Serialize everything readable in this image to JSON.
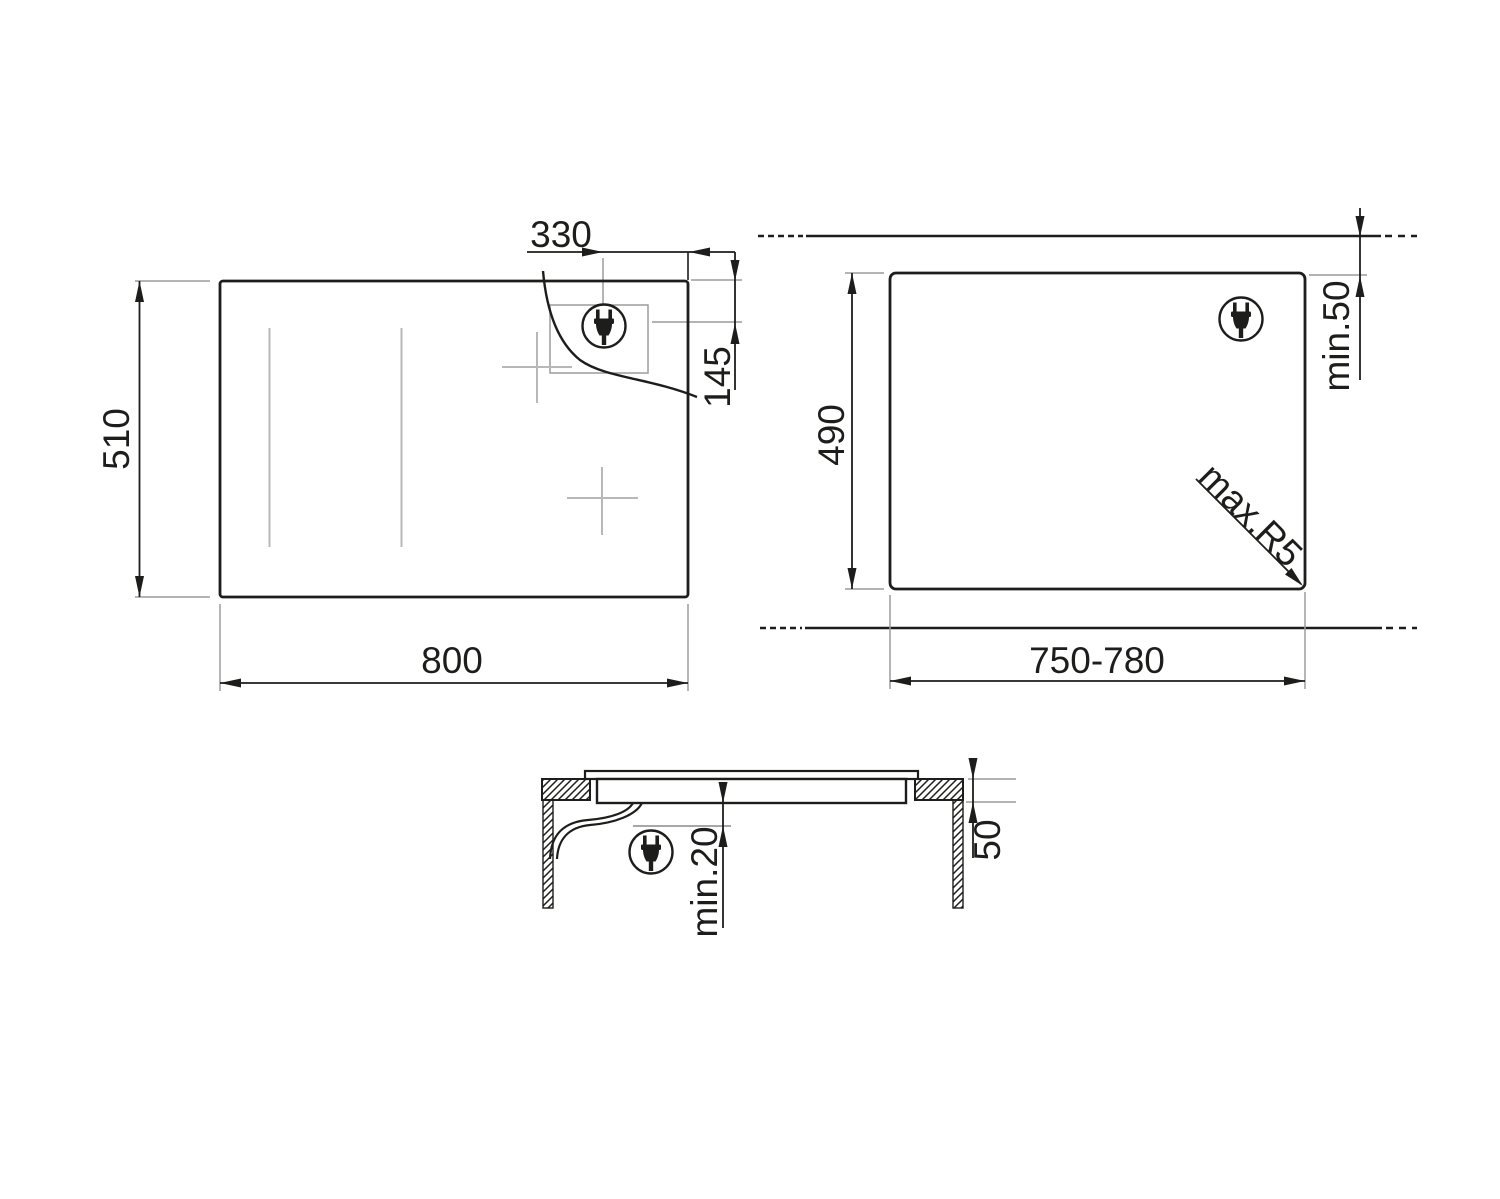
{
  "drawing": {
    "background": "#ffffff",
    "colors": {
      "line": "#1d1d1b",
      "extension": "#9c9c9c",
      "zone": "#b8b8b8"
    },
    "icons": {
      "plug": "power-plug-icon"
    },
    "views": {
      "hob_top": {
        "name": "hob top view",
        "dims": {
          "width": "800",
          "depth": "510",
          "plug_to_right_edge": "330",
          "plug_from_top_edge": "145"
        }
      },
      "cutout": {
        "name": "worktop cutout view",
        "dims": {
          "width": "750-780",
          "depth": "490",
          "rear_clearance": "min.50",
          "corner_radius": "max.R5"
        }
      },
      "section": {
        "name": "installation section view",
        "dims": {
          "clearance_below": "min.20",
          "worktop_thickness": "50"
        }
      }
    }
  }
}
